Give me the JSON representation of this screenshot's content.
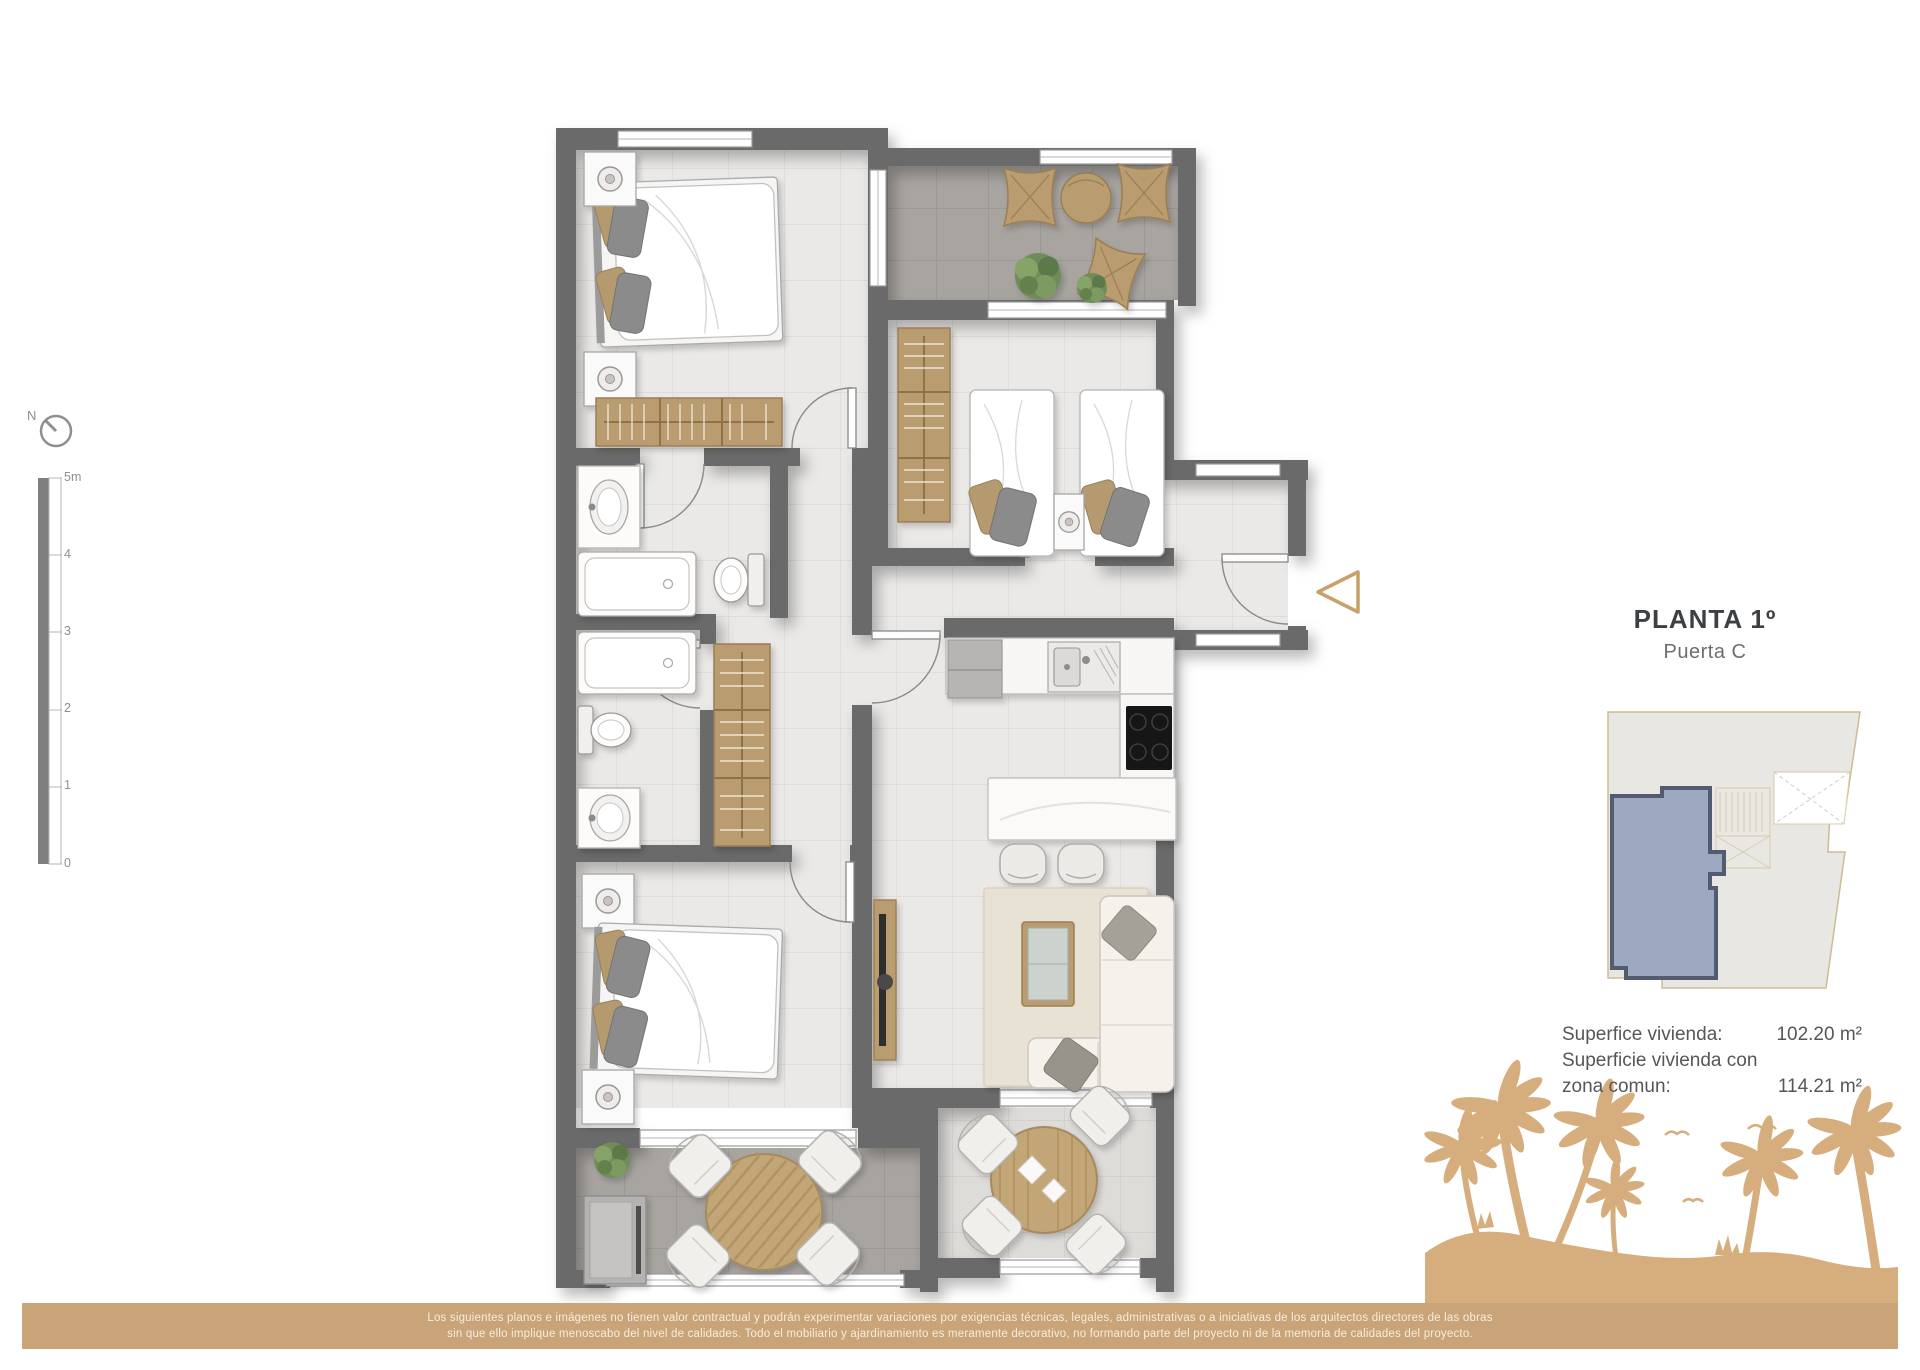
{
  "title": {
    "floor_label": "PLANTA 1º",
    "door_label": "Puerta C"
  },
  "area_info": {
    "rows": [
      {
        "label": "Superfice vivienda:",
        "value": "102.20 m²"
      },
      {
        "label": "Superficie vivienda con",
        "value": ""
      },
      {
        "label": "zona comun:",
        "value": "114.21 m²"
      }
    ]
  },
  "scale_bar": {
    "north_label": "N",
    "unit_top": "5m",
    "ticks": [
      "4",
      "3",
      "2",
      "1",
      "0"
    ]
  },
  "disclaimer": {
    "line1": "Los siguientes planos e imágenes no tienen valor contractual y podrán experimentar variaciones por exigencias técnicas, legales, administrativas o a iniciativas de los arquitectos directores de las obras",
    "line2": "sin que ello implique menoscabo del nivel de calidades. Todo el mobiliario y ajardinamiento es meramente decorativo, no formando parte del proyecto ni de la memoria de calidades del proyecto."
  },
  "colors": {
    "wall": "#6b6b6b",
    "floor_interior": "#eae9e7",
    "floor_terrace_dark": "#a8a4a0",
    "floor_terrace_light": "#dedcd9",
    "wood": "#b99c6f",
    "entrance_arrow": "#c9a06a",
    "key_plan_highlight": "#9aa5c0",
    "key_plan_outline": "#525b70",
    "palms_and_bar": "#c9a478",
    "palm_silhouette": "#d6ae7e"
  },
  "floor_plan": {
    "rooms": [
      "bedroom-1",
      "terrace-top",
      "bedroom-2",
      "entrance-hall",
      "bathroom-1",
      "bathroom-2",
      "corridor",
      "kitchen-living",
      "bedroom-3",
      "terrace-bottom-left",
      "terrace-bottom-right"
    ],
    "furniture": [
      "double-bed",
      "twin-beds",
      "nightstand",
      "table-lamp",
      "wardrobe",
      "bathtub",
      "washbasin",
      "toilet",
      "kitchen-counter",
      "fridge",
      "kitchen-sink",
      "cooktop",
      "kitchen-island",
      "bar-stool",
      "sofa",
      "cushions",
      "coffee-table",
      "rug",
      "tv-unit",
      "lounge-chair",
      "side-table",
      "plant",
      "outdoor-round-table",
      "outdoor-chair",
      "storage-cabinet",
      "dining-round-table"
    ]
  }
}
